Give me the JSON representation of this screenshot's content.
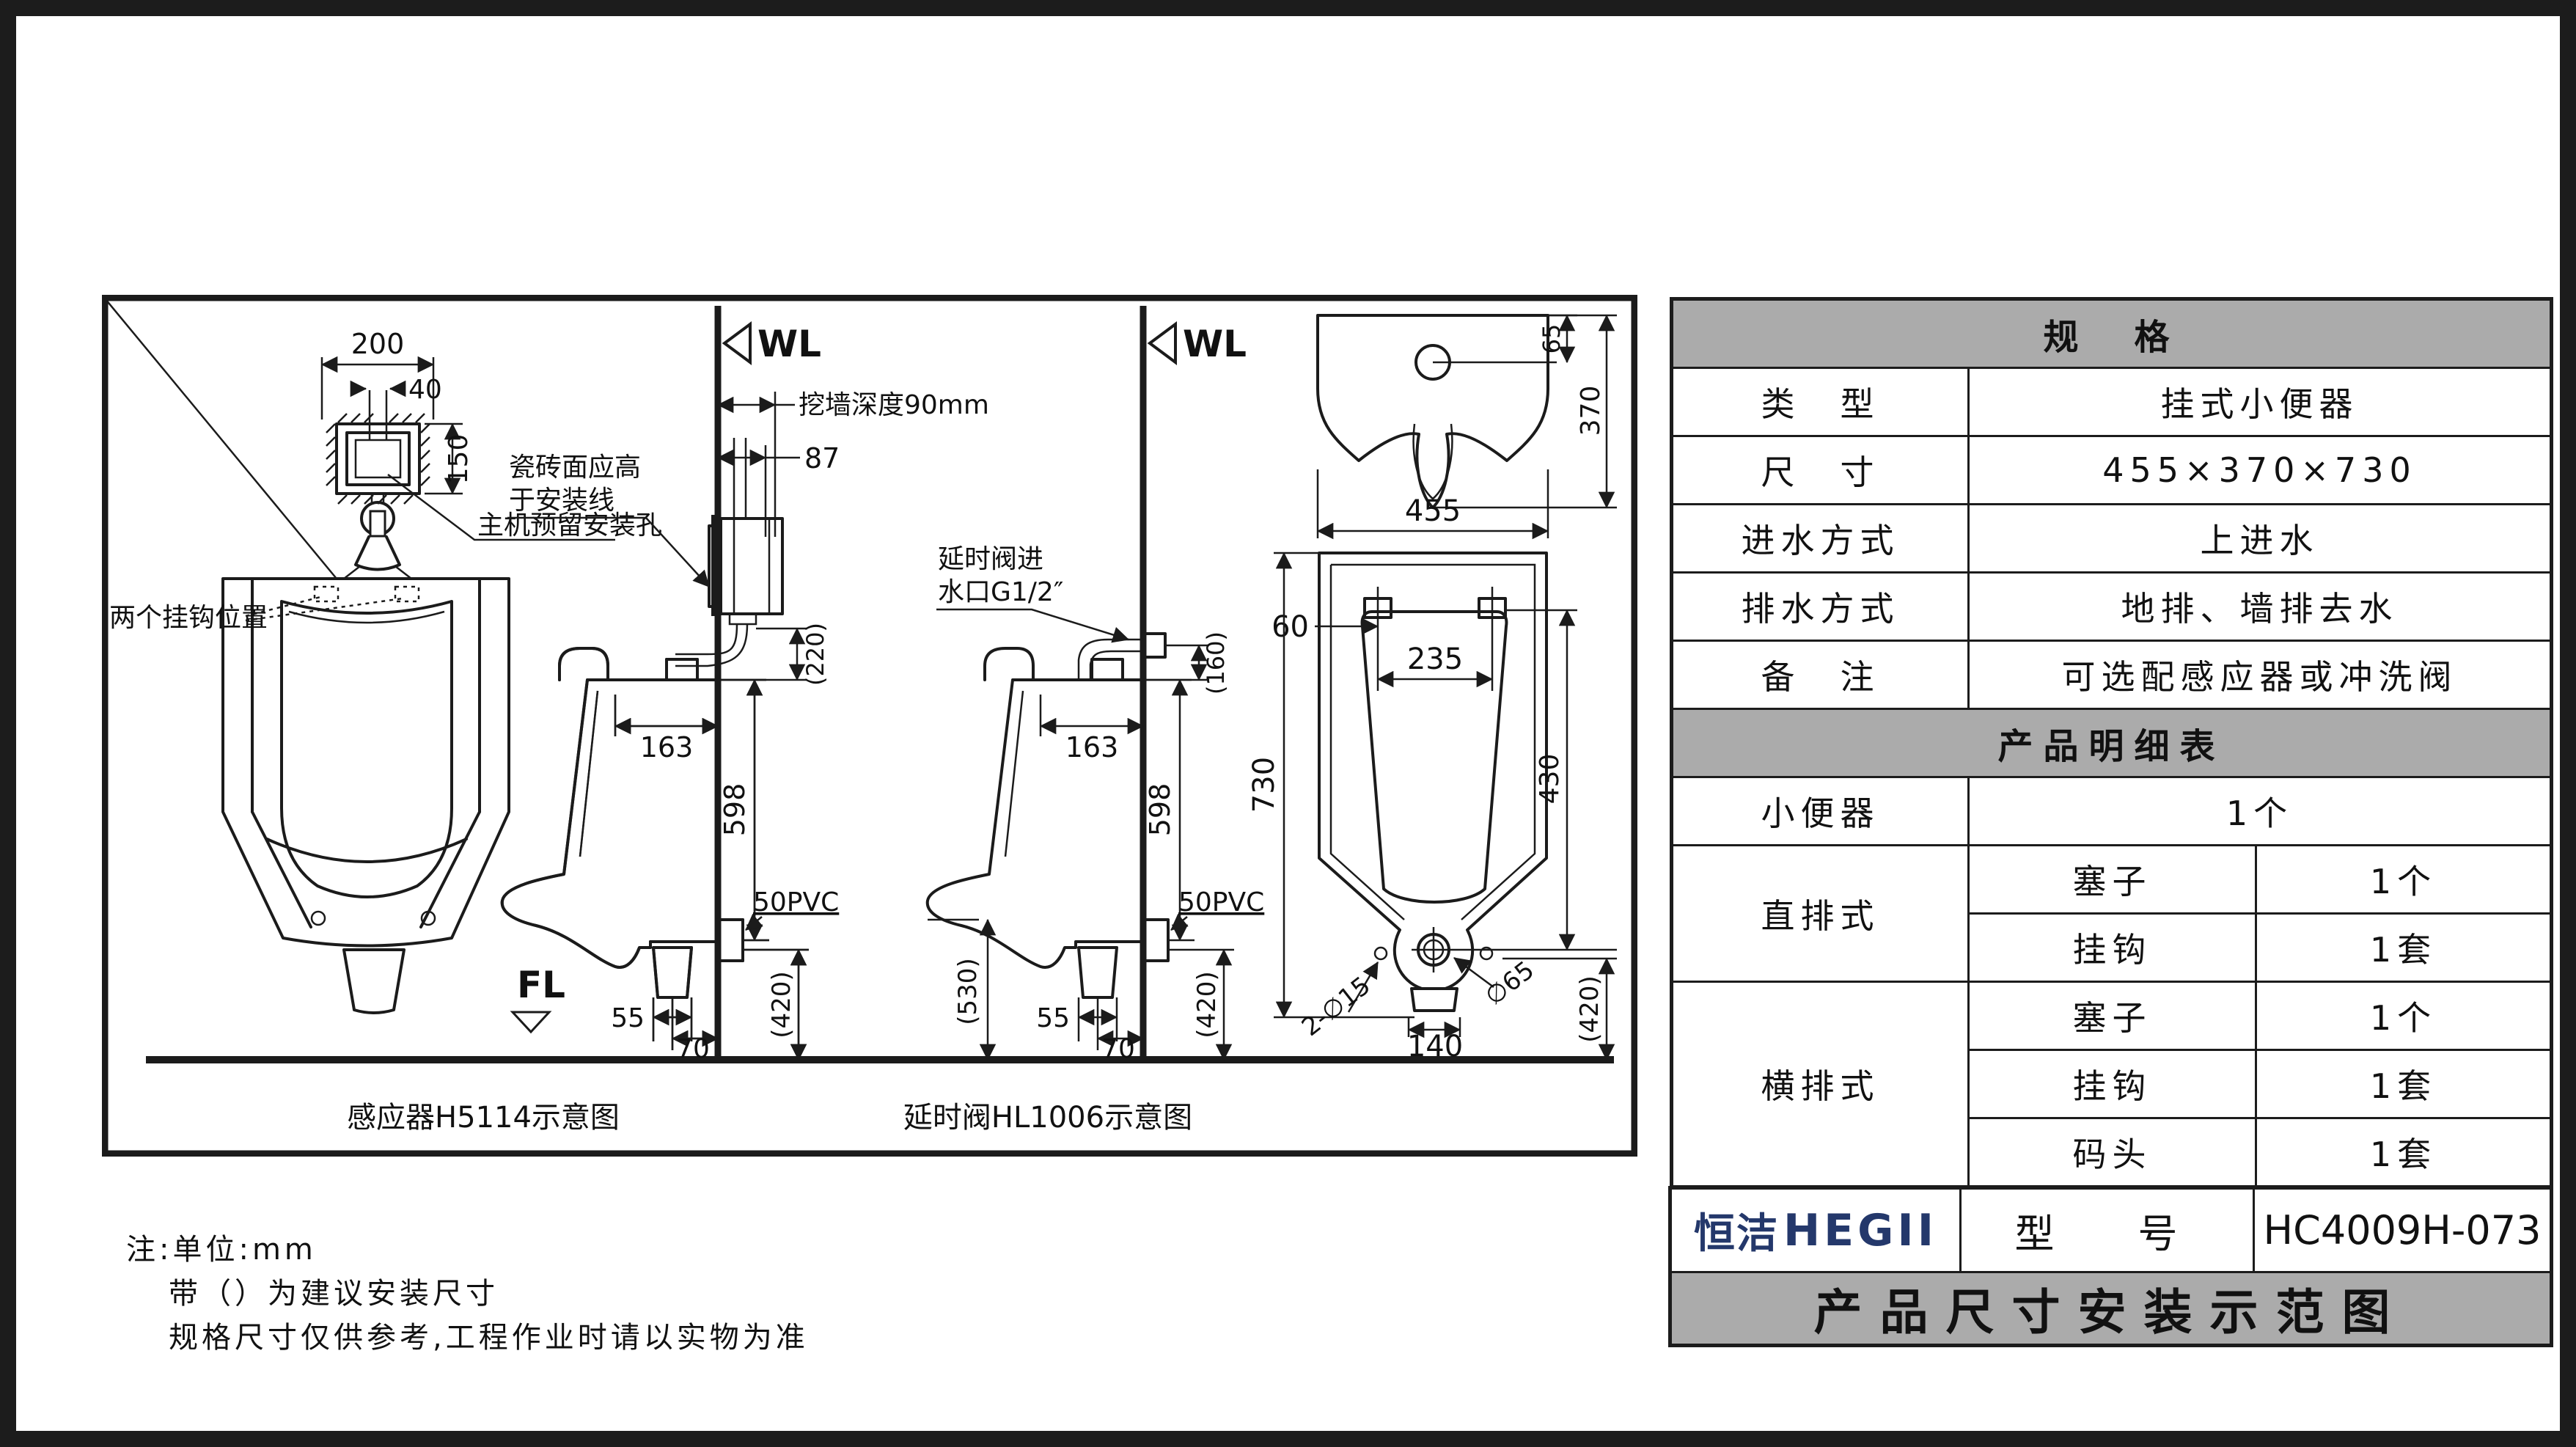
{
  "colors": {
    "accent_navy": "#24386b",
    "header_gray": "#ababab",
    "line": "#1b1b1b"
  },
  "spec_table": {
    "title": "规　格",
    "rows": [
      {
        "label": "类　型",
        "value": "挂式小便器"
      },
      {
        "label": "尺　寸",
        "value": "455×370×730"
      },
      {
        "label": "进水方式",
        "value": "上进水"
      },
      {
        "label": "排水方式",
        "value": "地排、墙排去水"
      },
      {
        "label": "备　注",
        "value": "可选配感应器或冲洗阀"
      }
    ]
  },
  "detail_table": {
    "title": "产品明细表",
    "urinal_label": "小便器",
    "urinal_qty": "1个",
    "groups": [
      {
        "label": "直排式",
        "items": [
          {
            "name": "塞子",
            "qty": "1个"
          },
          {
            "name": "挂钩",
            "qty": "1套"
          }
        ]
      },
      {
        "label": "横排式",
        "items": [
          {
            "name": "塞子",
            "qty": "1个"
          },
          {
            "name": "挂钩",
            "qty": "1套"
          },
          {
            "name": "码头",
            "qty": "1套"
          }
        ]
      }
    ]
  },
  "brand": {
    "logo_cn": "恒洁",
    "logo_en": "HEGII",
    "model_label": "型　号",
    "model_value": "HC4009H-073",
    "footer_title": "产品尺寸安装示范图"
  },
  "notes": {
    "line1": "注:单位:mm",
    "line2": "带（）为建议安装尺寸",
    "line3": "规格尺寸仅供参考,工程作业时请以实物为准"
  },
  "drawings": {
    "captions": {
      "sensor": "感应器H5114示意图",
      "delay_valve": "延时阀HL1006示意图"
    },
    "front_view": {
      "dim_200": "200",
      "dim_40": "40",
      "dim_150": "150",
      "mount_hole_label": "主机预留安装孔",
      "hooks_label": "两个挂钩位置",
      "fl": "FL"
    },
    "sensor_view": {
      "wl": "WL",
      "wall_depth": "挖墙深度90mm",
      "dim_87": "87",
      "tile_note_1": "瓷砖面应高",
      "tile_note_2": "于安装线",
      "dim_220": "(220)",
      "dim_163": "163",
      "dim_598": "598",
      "pvc": "50PVC",
      "dim_55": "55",
      "dim_70": "70",
      "dim_420": "(420)"
    },
    "delay_view": {
      "wl": "WL",
      "inlet_1": "延时阀进",
      "inlet_2": "水口G1/2″",
      "dim_160": "(160)",
      "dim_163": "163",
      "dim_598": "598",
      "pvc": "50PVC",
      "dim_55": "55",
      "dim_70": "70",
      "dim_420": "(420)",
      "dim_530": "(530)"
    },
    "product_views": {
      "dim_65": "65",
      "dim_370": "370",
      "dim_455": "455",
      "dim_60": "60",
      "dim_235": "235",
      "dim_730": "730",
      "dim_430": "430",
      "dim_2d15": "2-∅15",
      "dim_d65": "∅65",
      "dim_140": "140",
      "dim_420": "(420)"
    }
  }
}
